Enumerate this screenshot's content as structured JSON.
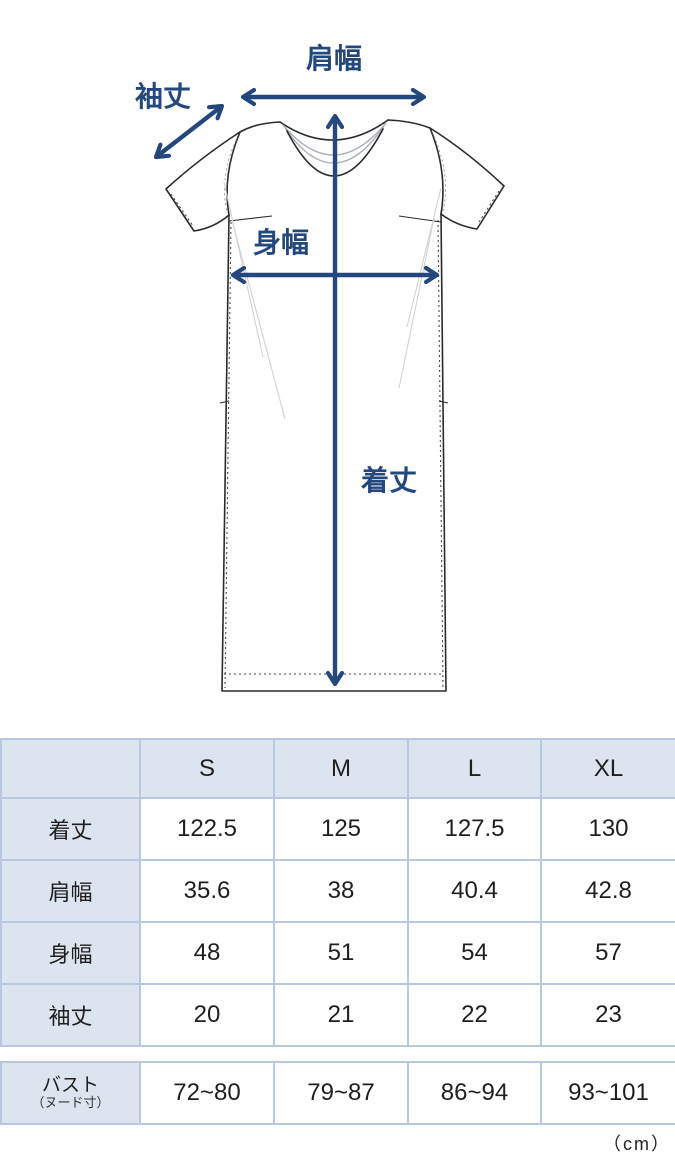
{
  "diagram": {
    "labels": {
      "shoulder_width": "肩幅",
      "sleeve_length": "袖丈",
      "body_width": "身幅",
      "garment_length": "着丈"
    }
  },
  "table": {
    "columns": [
      "",
      "S",
      "M",
      "L",
      "XL"
    ],
    "rows": [
      {
        "label": "着丈",
        "values": [
          "122.5",
          "125",
          "127.5",
          "130"
        ]
      },
      {
        "label": "肩幅",
        "values": [
          "35.6",
          "38",
          "40.4",
          "42.8"
        ]
      },
      {
        "label": "身幅",
        "values": [
          "48",
          "51",
          "54",
          "57"
        ]
      },
      {
        "label": "袖丈",
        "values": [
          "20",
          "21",
          "22",
          "23"
        ]
      }
    ],
    "bust": {
      "label": "バスト",
      "label_sub": "（ヌード寸）",
      "values": [
        "72~80",
        "79~87",
        "86~94",
        "93~101"
      ]
    },
    "unit": "（cm）"
  },
  "colors": {
    "accent_navy": "#24487e",
    "table_header_bg": "#dce4f0",
    "table_border": "#b7c8e0",
    "garment_line": "#2b2b2b"
  }
}
